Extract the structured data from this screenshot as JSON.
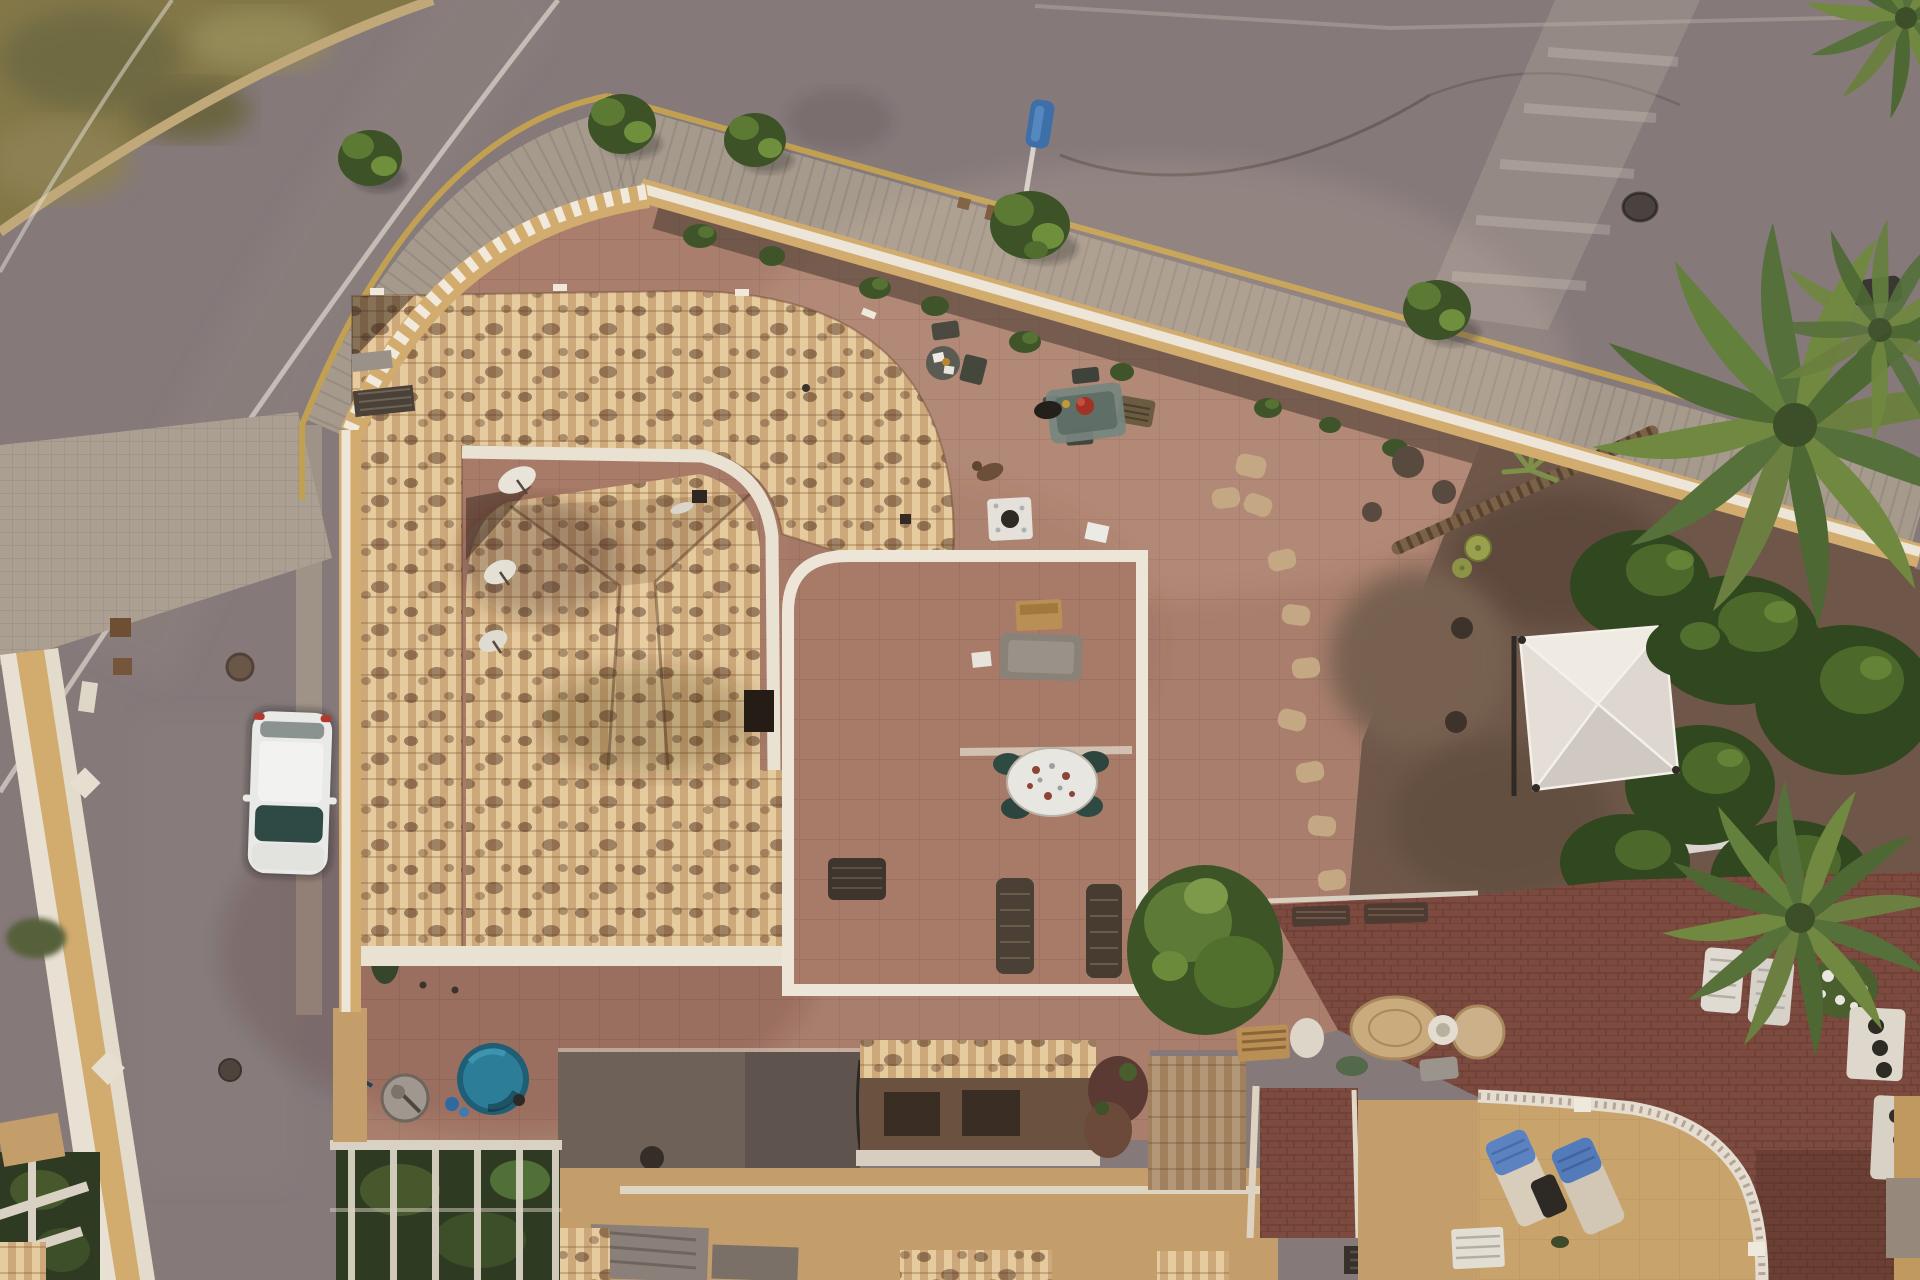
{
  "scene": {
    "type": "aerial-drone-photograph",
    "setting": "Top-down dusk view of a Mediterranean villa with tiled roof, large terracotta patio, perimeter wall, curving road, gardens and neighbouring terraces",
    "palette": {
      "road": "#85797a",
      "side_street": "#8b7f7d",
      "road_line": "#d8d2c8",
      "grass": "#837748",
      "grass_dark": "#6a6540",
      "curb_yellow": "#c2a052",
      "sidewalk": "#a69a8d",
      "crossing": "#aca093",
      "wall_tan": "#d2ac6e",
      "wall_top": "#ece5d8",
      "planter_soil": "#46392e",
      "patio": "#a97e6d",
      "terrace_floor": "#a87b69",
      "roof_base": "#d9b98b",
      "roof_trim": "#e9e1d2",
      "pool": "#2c7e98",
      "pool_deep": "#1f5e74",
      "garden_soil": "#6e5749",
      "stepping_stone": "#c4a783",
      "rock": "#584a3e",
      "cactus": "#9aa04e",
      "shrub_dark": "#3f5529",
      "shrub_light": "#5d7a36",
      "palm_green": "#6b8040",
      "gazebo": "#efebe3",
      "gazebo_shade": "#cfc9c2",
      "maroon_terrace": "#7c4a3f",
      "neighbor_terrace": "#c9a36c",
      "balustrade": "#e5ddd0",
      "lounger_white": "#dfdad2",
      "towel_blue": "#5d82c1",
      "car_body": "#e9e9e7",
      "car_glass": "#2f4a45",
      "car_taillight": "#b03a2e",
      "slab_grey": "#6e6158",
      "sign_blue": "#3f6fa8",
      "pole_white": "#d8d2c8",
      "wood": "#b98f56",
      "wicker": "#4a4036",
      "bench_grey": "#8a8178",
      "cloth_white": "#e8e6e0",
      "dog_brown": "#6b4f38",
      "accent_red": "#a33226",
      "lower_wall": "#c49e6a",
      "dark_window": "#3a2d24"
    },
    "objects": [
      {
        "id": "road",
        "label": "asphalt road curving around the property"
      },
      {
        "id": "grass-verge",
        "label": "dry grass verge in top-left corner"
      },
      {
        "id": "road-centerline",
        "label": "white painted centerline"
      },
      {
        "id": "crosswalk",
        "label": "faded pedestrian crossing on upper road"
      },
      {
        "id": "sidewalk",
        "label": "paved sidewalk with yellow curb line"
      },
      {
        "id": "street-sign",
        "label": "blue street sign on white pole"
      },
      {
        "id": "street-trees",
        "label": "young trees along the sidewalk"
      },
      {
        "id": "perimeter-wall",
        "label": "ochre perimeter wall with white crenellated top"
      },
      {
        "id": "planter-hedge",
        "label": "planting bed with shrubs inside the wall"
      },
      {
        "id": "patio",
        "label": "large terracotta tiled patio"
      },
      {
        "id": "villa-roof",
        "label": "C-shaped terracotta barrel tile roof"
      },
      {
        "id": "inner-roof",
        "label": "lower hipped roof inside the courtyard"
      },
      {
        "id": "roof-walkway",
        "label": "white parapet walkway with satellite dishes"
      },
      {
        "id": "roof-terrace",
        "label": "white walled roof terrace"
      },
      {
        "id": "terrace-table",
        "label": "round table with white tablecloth and green chairs"
      },
      {
        "id": "wicker-loungers",
        "label": "two dark wicker sun loungers"
      },
      {
        "id": "bistro-table",
        "label": "small round table with two chairs"
      },
      {
        "id": "patio-table",
        "label": "patio table with red centrepiece and chairs"
      },
      {
        "id": "dog",
        "label": "small dog lying on the patio"
      },
      {
        "id": "side-table",
        "label": "small square white table"
      },
      {
        "id": "garden-bench",
        "label": "bench and wooden crate"
      },
      {
        "id": "pool",
        "label": "small round splash pool"
      },
      {
        "id": "pool-dish",
        "label": "satellite dish beside the pool"
      },
      {
        "id": "pergola",
        "label": "white pergola over dark planting"
      },
      {
        "id": "lower-terrace",
        "label": "shaded lower terrace slab"
      },
      {
        "id": "lower-buildings",
        "label": "lower buildings and roof fragments"
      },
      {
        "id": "rock-garden",
        "label": "rock garden with stepping stones and barrel cacti"
      },
      {
        "id": "palm-trunk",
        "label": "leaning palm trunk"
      },
      {
        "id": "garden-shrubs",
        "label": "dense shrubs along east boundary"
      },
      {
        "id": "gazebo",
        "label": "white pyramid gazebo canopy"
      },
      {
        "id": "small-canopy",
        "label": "small grey canopy"
      },
      {
        "id": "palm-large",
        "label": "large palm crown on east side"
      },
      {
        "id": "palm-south",
        "label": "palm crown at south-east corner"
      },
      {
        "id": "maroon-terrace",
        "label": "maroon brick tiled terrace"
      },
      {
        "id": "white-loungers",
        "label": "two white plastic sun loungers"
      },
      {
        "id": "flower-bush",
        "label": "white flowering bush"
      },
      {
        "id": "planter-pots",
        "label": "white planter boxes with pots"
      },
      {
        "id": "balustrade",
        "label": "curved white balustrade"
      },
      {
        "id": "neighbor-terrace",
        "label": "neighbouring tan terrace"
      },
      {
        "id": "towel-loungers",
        "label": "two loungers draped with blue towels"
      },
      {
        "id": "rattan-baskets",
        "label": "round rattan mats and baskets"
      },
      {
        "id": "storage-crate",
        "label": "slatted wooden crate"
      },
      {
        "id": "garden-tree",
        "label": "round green tree"
      },
      {
        "id": "white-car",
        "label": "white hatchback parked on the side street"
      },
      {
        "id": "side-street",
        "label": "side street with manholes"
      },
      {
        "id": "neighbor-wall",
        "label": "neighbouring villa wall with diamond motifs"
      }
    ]
  }
}
